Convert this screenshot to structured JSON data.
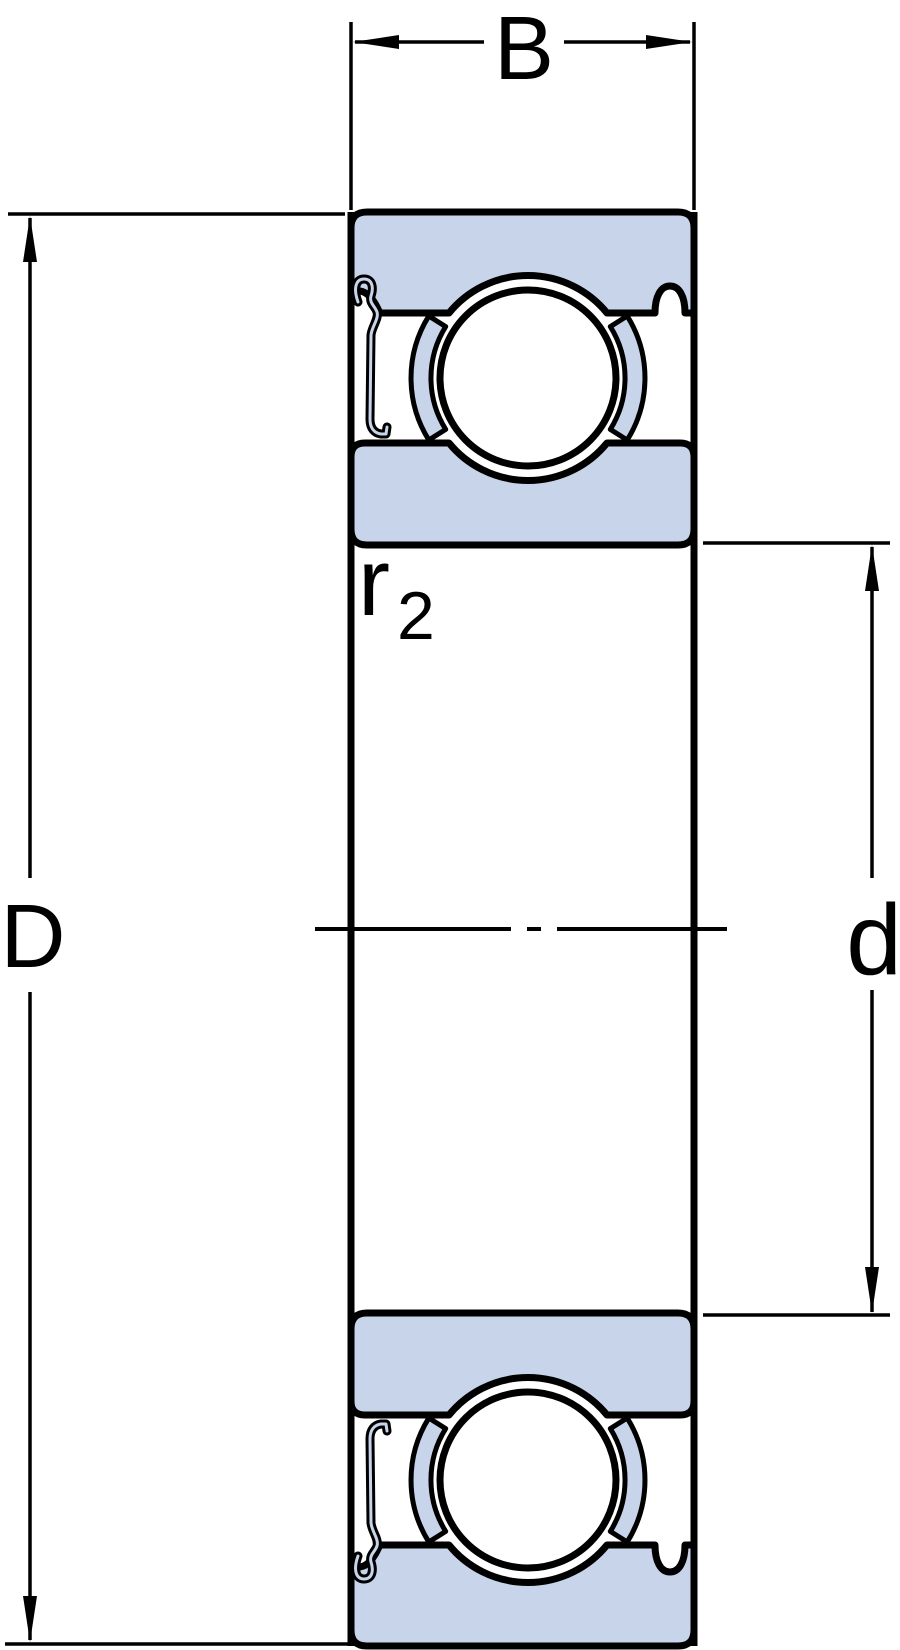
{
  "figure": {
    "labels": {
      "width": "B",
      "outer_diameter": "D",
      "bore_diameter": "d",
      "fillet_radius": "r",
      "fillet_radius_subscript": "2"
    },
    "colors": {
      "ring_fill": "#C7D4E9",
      "line": "#000000",
      "background": "#FFFFFF"
    }
  }
}
